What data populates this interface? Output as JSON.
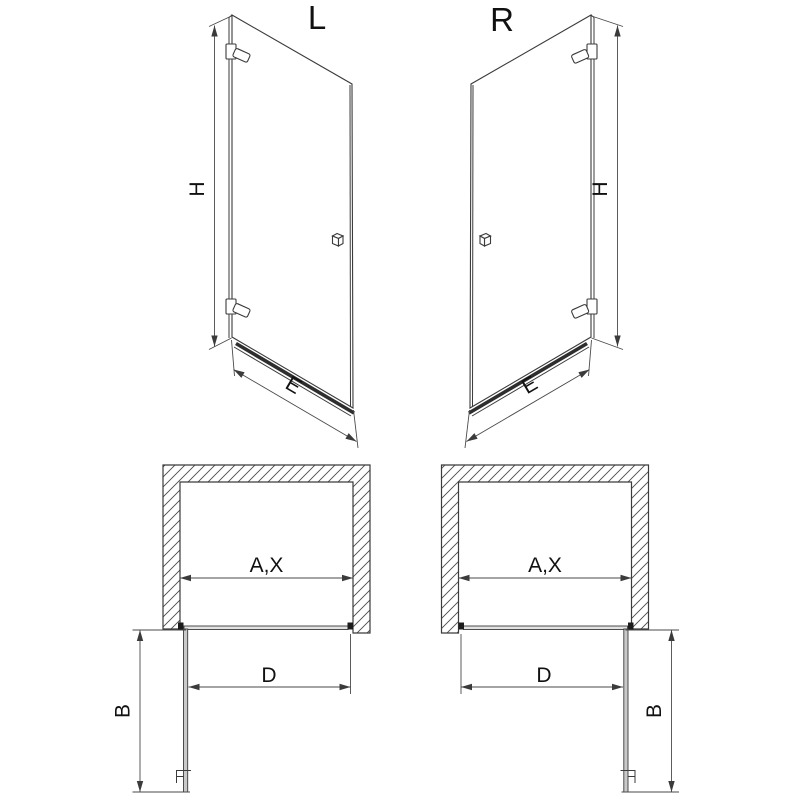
{
  "drawing": {
    "variant_labels": {
      "left": "L",
      "right": "R"
    },
    "dimension_labels": {
      "height": "H",
      "panel_width": "E",
      "opening_width": "A,X",
      "door_width": "D",
      "depth": "B"
    }
  },
  "colors": {
    "line": "#3b3b3b",
    "dimension_line": "#4a4a4a",
    "glass_fill": "#ffffff",
    "open_door_fill": "#c9c9c9",
    "threshold": "#2e2e2e",
    "marker": "#1c1c1c",
    "background": "#ffffff"
  }
}
